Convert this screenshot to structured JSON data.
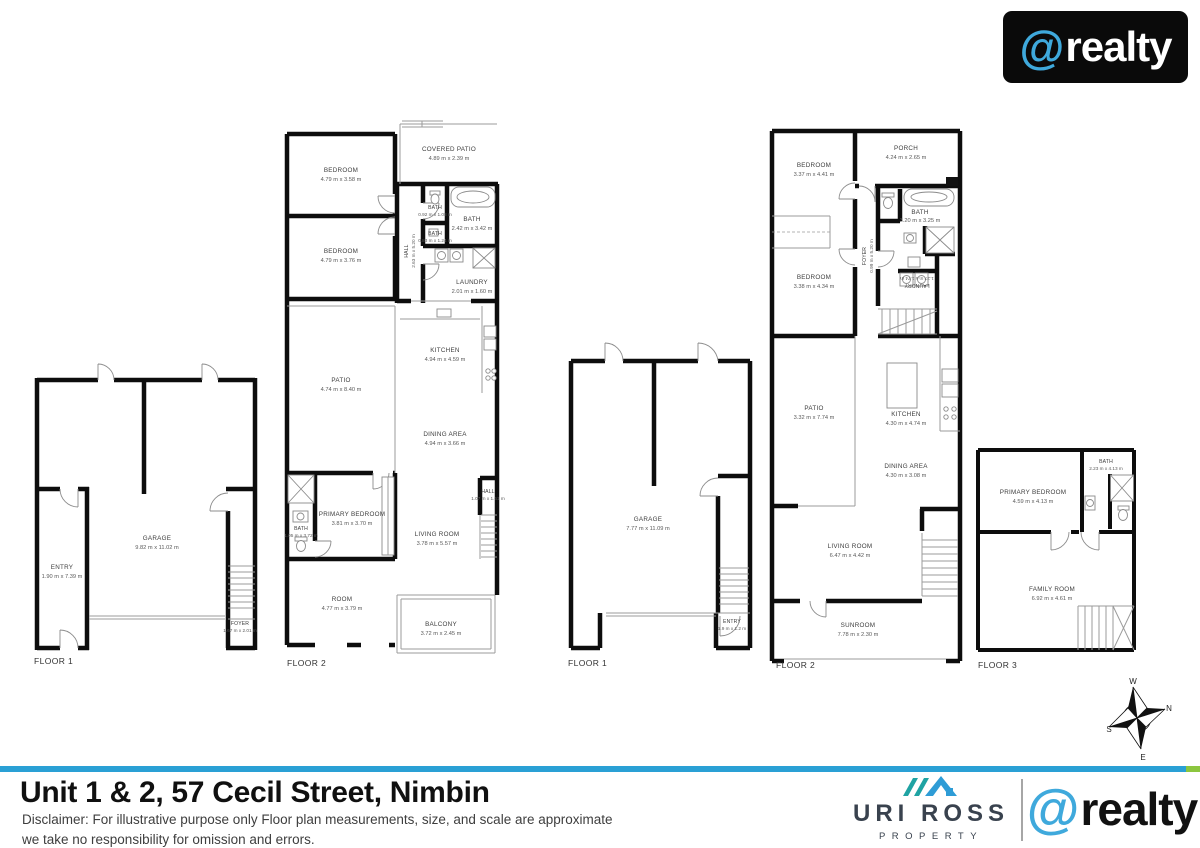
{
  "branding": {
    "at": "@",
    "word": "realty"
  },
  "colors": {
    "brand_blue": "#3FA9DC",
    "logo_black": "#0a0a0a",
    "bar_blue": "#2AA0D5",
    "bar_green": "#8CC63F",
    "agency_teal": "#1FA3A3",
    "agency_blue": "#2E9CD6",
    "agency_text": "#39424E"
  },
  "plans": {
    "unit1_floor1": {
      "floor_label": "FLOOR 1",
      "rooms": {
        "garage": {
          "name": "GARAGE",
          "dims": "9.82 m x 11.02 m"
        },
        "entry": {
          "name": "ENTRY",
          "dims": "1.90 m x 7.39 m"
        },
        "foyer": {
          "name": "FOYER",
          "dims": "1.67 m x 2.01 m"
        }
      }
    },
    "unit1_floor2": {
      "floor_label": "FLOOR 2",
      "rooms": {
        "bedroom1": {
          "name": "BEDROOM",
          "dims": "4.79 m x 3.58 m"
        },
        "bedroom2": {
          "name": "BEDROOM",
          "dims": "4.79 m x 3.76 m"
        },
        "covered_patio": {
          "name": "COVERED PATIO",
          "dims": "4.89 m x 2.39 m"
        },
        "bath_small_top": {
          "name": "BATH",
          "dims": "0.92 m x 1.08 m"
        },
        "bath_main": {
          "name": "BATH",
          "dims": "2.42 m x 3.42 m"
        },
        "bath_small_mid": {
          "name": "BATH",
          "dims": "0.83 m x 1.24 m"
        },
        "hall": {
          "name": "HALL",
          "dims": "2.63 m x 5.20 m"
        },
        "laundry": {
          "name": "LAUNDRY",
          "dims": "2.01 m x 1.60 m"
        },
        "kitchen": {
          "name": "KITCHEN",
          "dims": "4.94 m x 4.59 m"
        },
        "patio": {
          "name": "PATIO",
          "dims": "4.74 m x 8.40 m"
        },
        "dining": {
          "name": "DINING AREA",
          "dims": "4.94 m x 3.66 m"
        },
        "hall_small": {
          "name": "HALL",
          "dims": "1.07 m x 1.61 m"
        },
        "primary_bedroom": {
          "name": "PRIMARY BEDROOM",
          "dims": "3.81 m x 3.70 m"
        },
        "bath_ensuite": {
          "name": "BATH",
          "dims": "1.05 m x 3.72 m"
        },
        "living": {
          "name": "LIVING ROOM",
          "dims": "3.78 m x 5.57 m"
        },
        "room": {
          "name": "ROOM",
          "dims": "4.77 m x 3.79 m"
        },
        "balcony": {
          "name": "BALCONY",
          "dims": "3.72 m x 2.45 m"
        }
      }
    },
    "unit2_floor1": {
      "floor_label": "FLOOR 1",
      "rooms": {
        "garage": {
          "name": "GARAGE",
          "dims": "7.77 m x 11.09 m"
        },
        "entry": {
          "name": "ENTRY",
          "dims": "1.9 m x 1.2 m"
        }
      }
    },
    "unit2_floor2": {
      "floor_label": "FLOOR 2",
      "rooms": {
        "bedroom1": {
          "name": "BEDROOM",
          "dims": "3.37 m x 4.41 m"
        },
        "porch": {
          "name": "PORCH",
          "dims": "4.24 m x 2.65 m"
        },
        "bath": {
          "name": "BATH",
          "dims": "3.20 m x 3.25 m"
        },
        "bedroom2": {
          "name": "BEDROOM",
          "dims": "3.38 m x 4.34 m"
        },
        "foyer": {
          "name": "FOYER",
          "dims": "0.99 m x 5.20 m"
        },
        "laundry": {
          "name": "LAUNDRY",
          "dims": "1.27 m x 1.74 m"
        },
        "patio": {
          "name": "PATIO",
          "dims": "3.32 m x 7.74 m"
        },
        "kitchen": {
          "name": "KITCHEN",
          "dims": "4.30 m x 4.74 m"
        },
        "dining": {
          "name": "DINING AREA",
          "dims": "4.30 m x 3.08 m"
        },
        "living": {
          "name": "LIVING ROOM",
          "dims": "6.47 m x 4.42 m"
        },
        "sunroom": {
          "name": "SUNROOM",
          "dims": "7.78 m x 2.30 m"
        }
      }
    },
    "unit2_floor3": {
      "floor_label": "FLOOR 3",
      "rooms": {
        "bath": {
          "name": "BATH",
          "dims": "2.23 m x 4.13 m"
        },
        "primary_bedroom": {
          "name": "PRIMARY BEDROOM",
          "dims": "4.59 m x 4.13 m"
        },
        "family": {
          "name": "FAMILY ROOM",
          "dims": "6.92 m x 4.61 m"
        }
      }
    }
  },
  "compass": {
    "n": "N",
    "s": "S",
    "e": "E",
    "w": "W"
  },
  "footer": {
    "title": "Unit 1 & 2, 57 Cecil Street, Nimbin",
    "disclaimer_line1": "Disclaimer: For illustrative purpose only Floor plan measurements, size, and scale are approximate",
    "disclaimer_line2": "we take no responsibility for omission and errors.",
    "agency_name": "URI ROSS",
    "agency_sub": "PROPERTY"
  }
}
